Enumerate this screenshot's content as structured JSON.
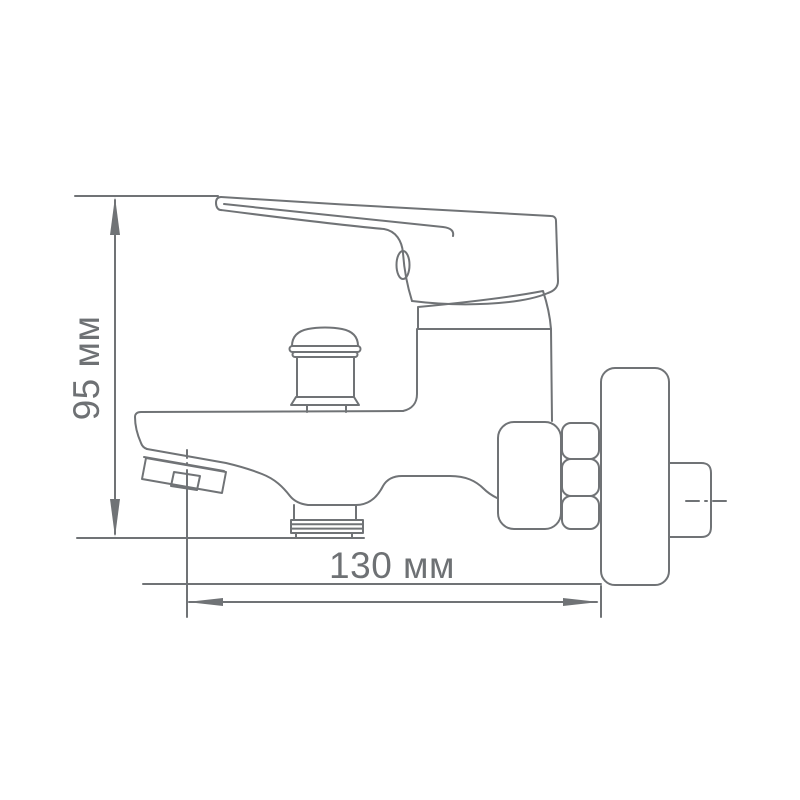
{
  "page": {
    "background": "#ffffff"
  },
  "drawing": {
    "type": "technical-line-drawing",
    "subject": "wall-mounted bath mixer faucet, side view",
    "line_color": "#707376",
    "text_color": "#6e7174"
  },
  "dimensions": {
    "height": {
      "label": "95 мм",
      "value": 95,
      "unit": "мм"
    },
    "width": {
      "label": "130 мм",
      "value": 130,
      "unit": "мм"
    }
  }
}
